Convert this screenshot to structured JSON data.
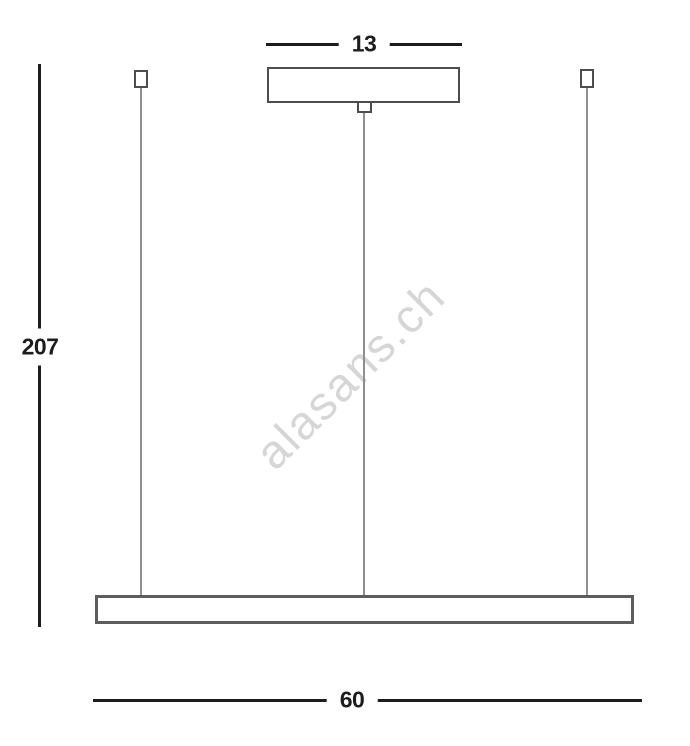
{
  "drawing": {
    "type": "technical-dimension-diagram",
    "subject": "linear-pendant-light",
    "labels": {
      "canopy_width": "13",
      "overall_height": "207",
      "fixture_length": "60"
    },
    "watermark": "alasans.ch",
    "colors": {
      "dimension_line": "#1d1d1d",
      "outline": "#4d4d4d",
      "fixture_bar_outline": "#5d5d5d",
      "wire": "#8f8f8f",
      "watermark": "#d6d6d6",
      "background": "#ffffff"
    }
  }
}
